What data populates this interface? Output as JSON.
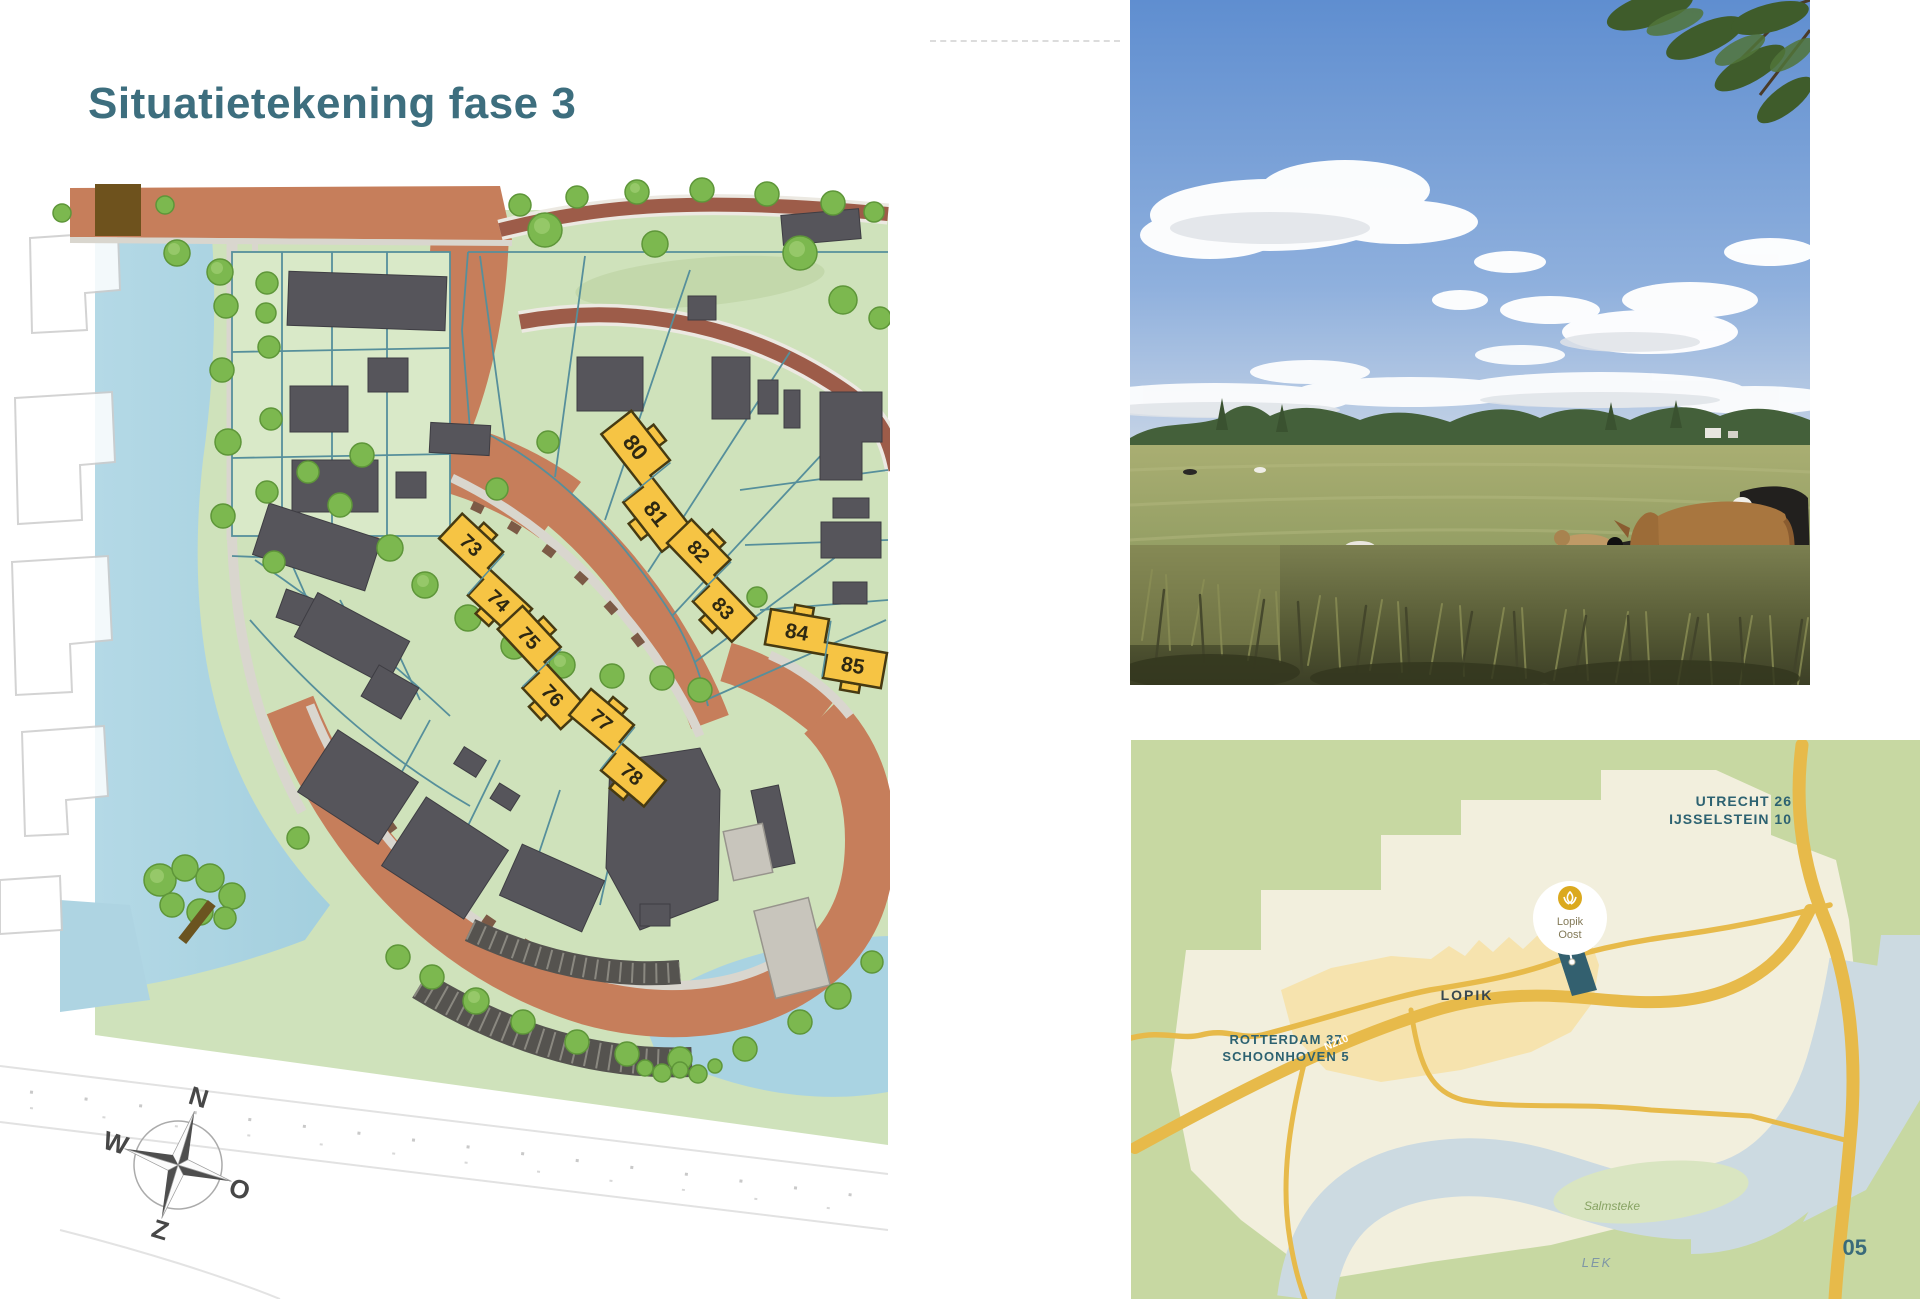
{
  "page": {
    "title": "Situatietekening fase 3",
    "page_number": "05"
  },
  "site_plan": {
    "plots": [
      "73",
      "74",
      "75",
      "76",
      "77",
      "78",
      "80",
      "81",
      "82",
      "83",
      "84",
      "85"
    ],
    "compass": {
      "north": "N",
      "east": "O",
      "south": "Z",
      "west": "W"
    }
  },
  "location_map": {
    "destinations_northeast": [
      "UTRECHT 26",
      "IJSSELSTEIN 10"
    ],
    "destinations_southwest": [
      "ROTTERDAM 37",
      "SCHOONHOVEN 5"
    ],
    "town_label": "LOPIK",
    "road_label": "N210",
    "marker_label": [
      "Lopik",
      "Oost"
    ],
    "recreation_area_label": "Salmsteke",
    "river_label": "LEK"
  },
  "colors": {
    "accent_teal": "#3d6e7e",
    "plot_yellow": "#f6c444",
    "road_terracotta": "#c67e5b",
    "map_road_yellow": "#e7ba4a",
    "water_blue": "#a9d3e2",
    "map_green": "#c7d8a2"
  }
}
